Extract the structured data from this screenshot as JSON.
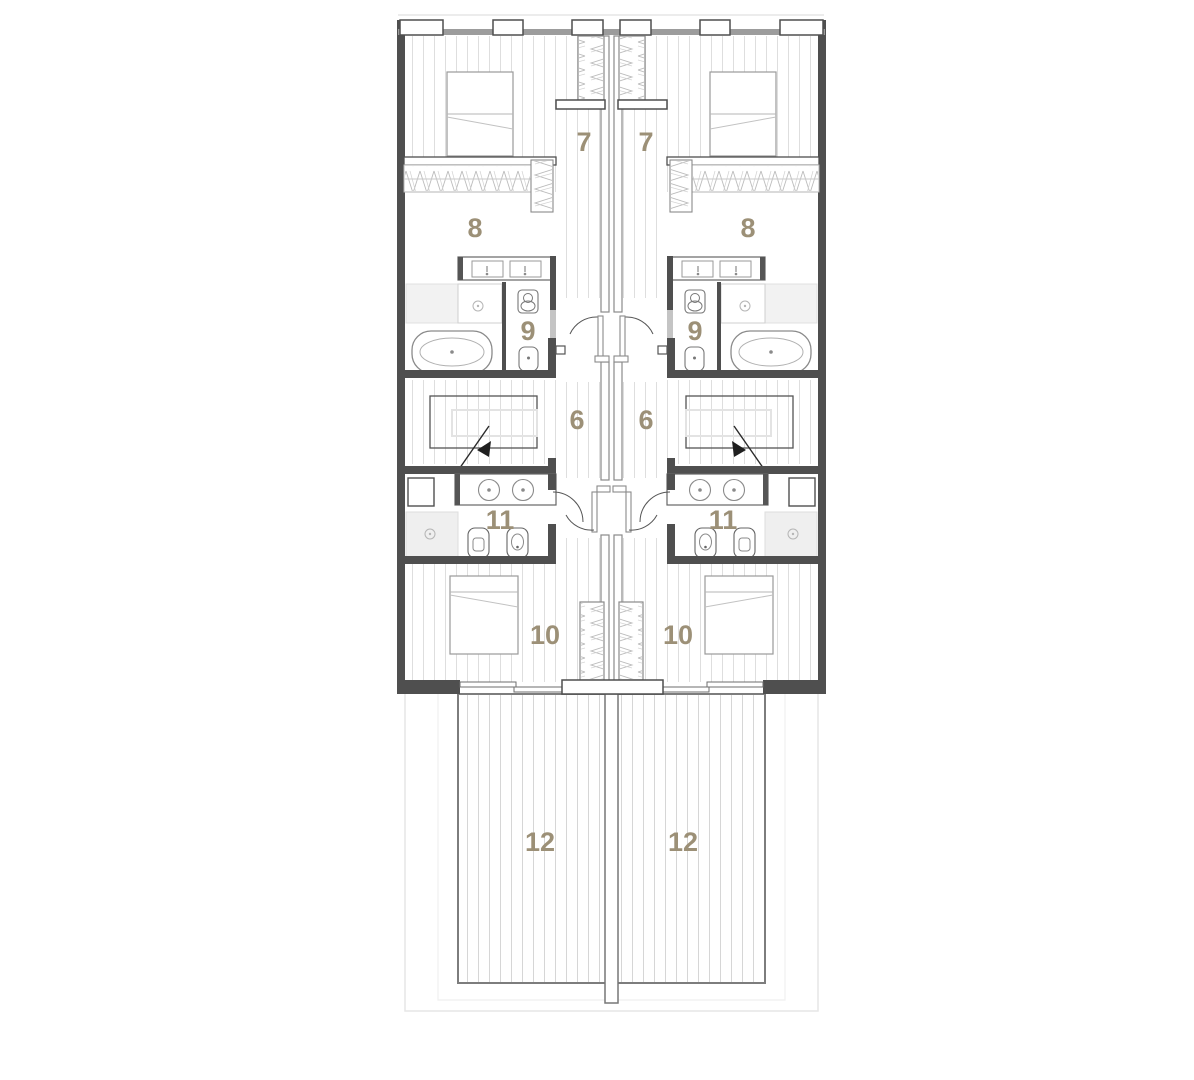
{
  "plan": {
    "room_labels": {
      "upper_bedroom": "7",
      "upper_bathroom": "8",
      "wc": "9",
      "stair_hall": "6",
      "lower_bathroom": "11",
      "lower_bedroom": "10",
      "terrace": "12"
    },
    "colors": {
      "room_label": "#9c9077",
      "wall": "#4f4f4f",
      "glazing_band": "#9c9c9c",
      "floorboard_line": "#dedede",
      "terrace_board_line": "#d6d6d6",
      "fixture_outline": "#8a8a8a",
      "site_boundary": "#e6e6e6"
    }
  }
}
